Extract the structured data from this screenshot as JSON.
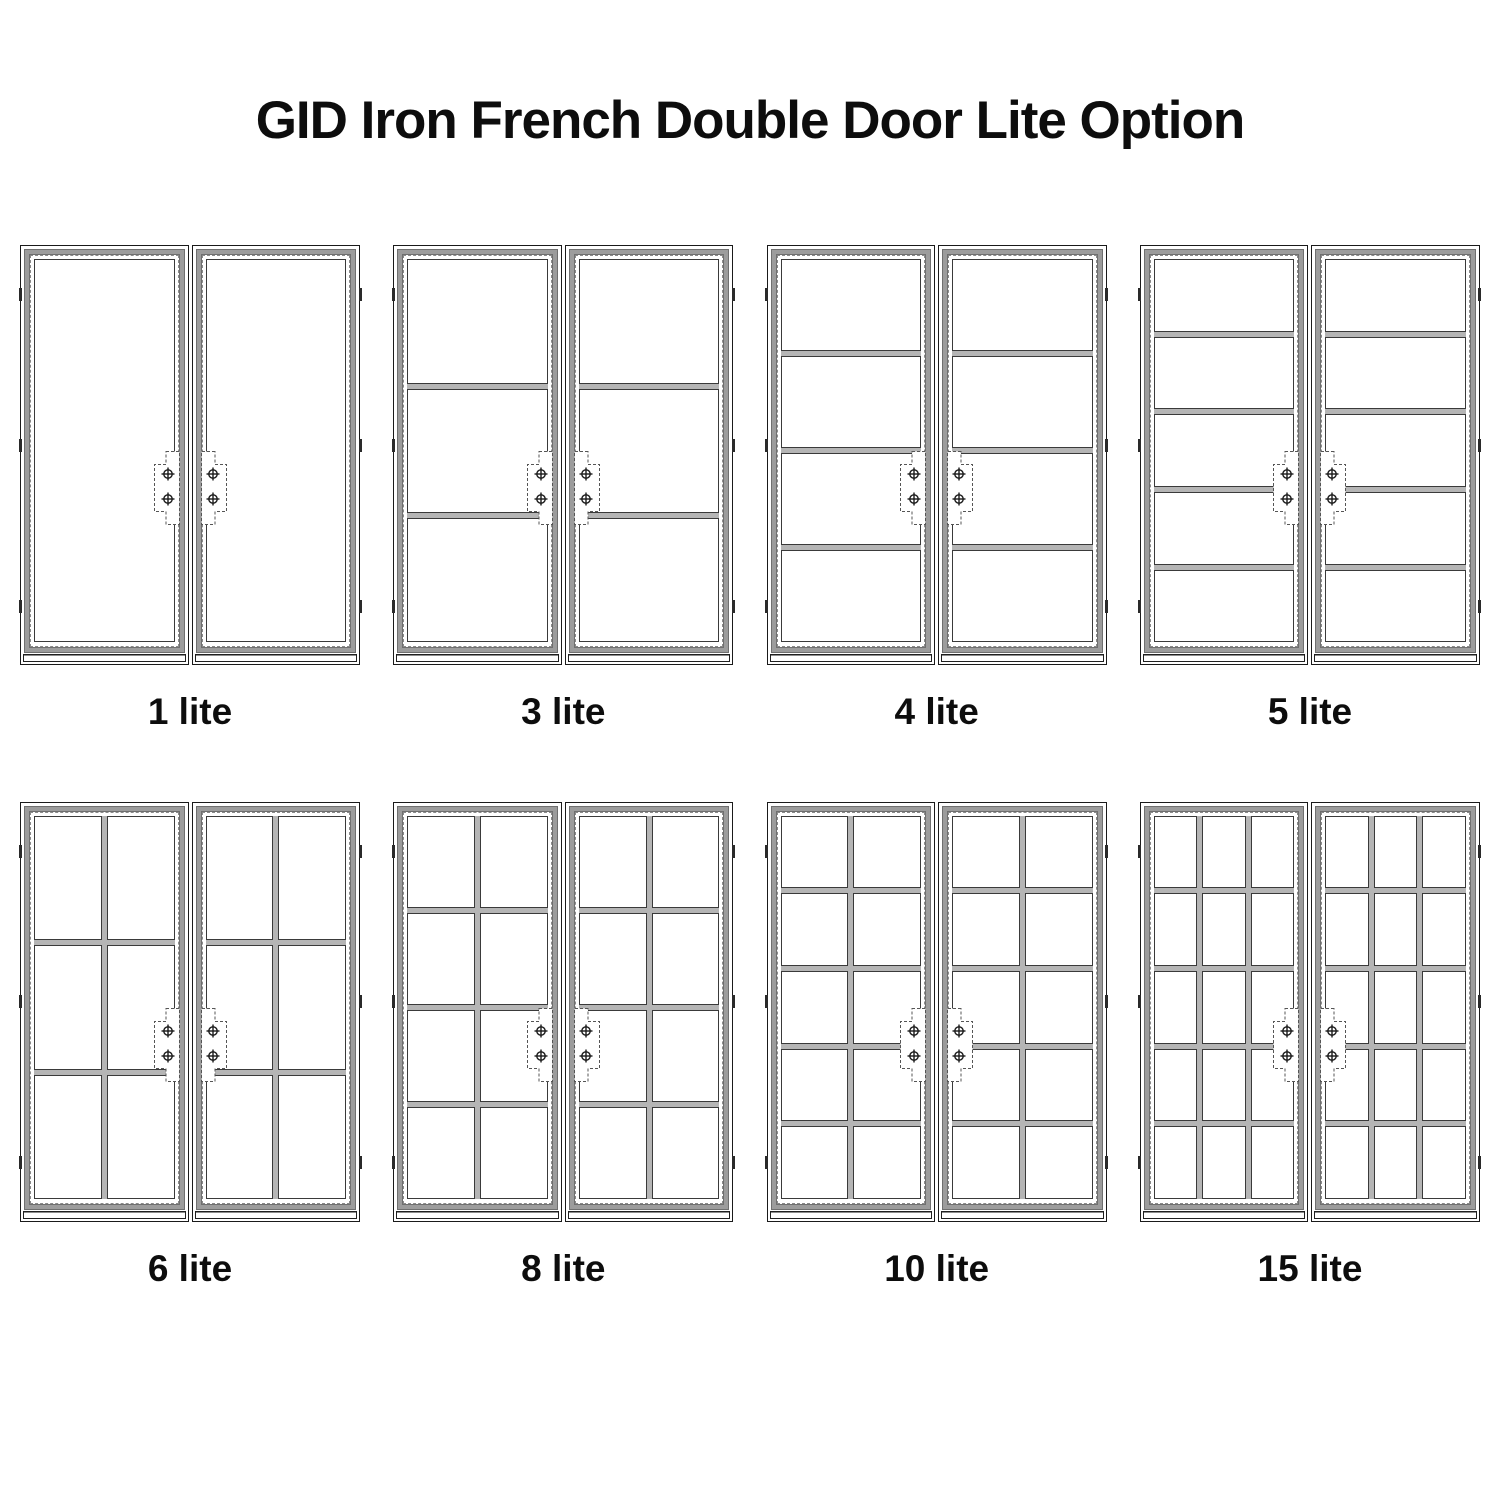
{
  "page": {
    "title": "GID Iron French Double Door Lite Option",
    "background": "#ffffff"
  },
  "colors": {
    "line": "#1a1a1a",
    "pane_line": "#3a3a3a",
    "muntin_fill": "#b5b5b5",
    "slab_band": "#9c9c9c",
    "band_edge": "#6f6f6f",
    "dashed_line": "#8a8a8a",
    "plate_outline": "#555555",
    "text": "#0d0d0d"
  },
  "drawing": {
    "panels_per_door": 2,
    "screws_per_handle_plate": 2,
    "hinges_per_side": 3,
    "screw_icon": "circle-cross-icon"
  },
  "doors": [
    {
      "id": "1-lite",
      "label": "1 lite",
      "lites": 1,
      "columns": 1,
      "rows": 1
    },
    {
      "id": "3-lite",
      "label": "3 lite",
      "lites": 3,
      "columns": 1,
      "rows": 3
    },
    {
      "id": "4-lite",
      "label": "4 lite",
      "lites": 4,
      "columns": 1,
      "rows": 4
    },
    {
      "id": "5-lite",
      "label": "5 lite",
      "lites": 5,
      "columns": 1,
      "rows": 5
    },
    {
      "id": "6-lite",
      "label": "6 lite",
      "lites": 6,
      "columns": 2,
      "rows": 3
    },
    {
      "id": "8-lite",
      "label": "8 lite",
      "lites": 8,
      "columns": 2,
      "rows": 4
    },
    {
      "id": "10-lite",
      "label": "10 lite",
      "lites": 10,
      "columns": 2,
      "rows": 5
    },
    {
      "id": "15-lite",
      "label": "15 lite",
      "lites": 15,
      "columns": 3,
      "rows": 5
    }
  ]
}
